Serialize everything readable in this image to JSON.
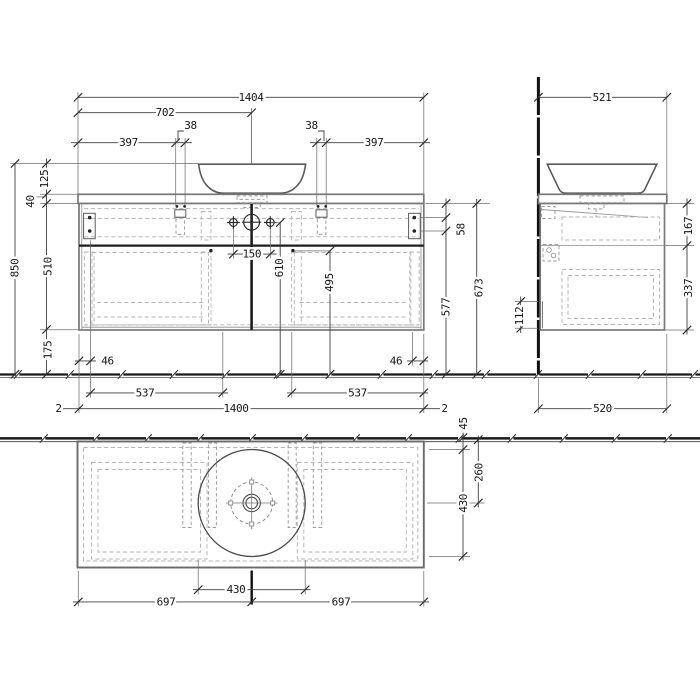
{
  "title": "Vanity unit technical drawing",
  "units": "mm",
  "front_view": {
    "dims": {
      "countertop_width": "1404",
      "center_offset": "702",
      "left_edge_to_bracket": "397",
      "bracket_width_left": "38",
      "bracket_width_right": "38",
      "bracket_to_right_edge": "397",
      "overall_height": "850",
      "basin_height": "125",
      "countertop_thickness": "40",
      "cabinet_height": "510",
      "lower_clearance": "175",
      "tap_hole_spacing": "150",
      "tap_hole_height": "610",
      "divider_height": "495",
      "bracket_drop": "58",
      "hanger_height": "577",
      "carcass_top_height": "673",
      "drawer_inset_left": "46",
      "drawer_inset_right": "46",
      "drawer_width_left": "537",
      "drawer_width_right": "537",
      "cabinet_width": "1400",
      "overhang_left": "2",
      "overhang_right": "2"
    }
  },
  "side_view": {
    "dims": {
      "countertop_depth": "521",
      "upper_section": "167",
      "lower_section": "337",
      "rear_cutout": "112",
      "cabinet_depth": "520"
    }
  },
  "plan_view": {
    "dims": {
      "basin_rear_gap": "45",
      "basin_center_from_rear": "260",
      "basin_depth": "430",
      "basin_diameter": "430",
      "left_center_span": "697",
      "right_center_span": "697"
    }
  }
}
